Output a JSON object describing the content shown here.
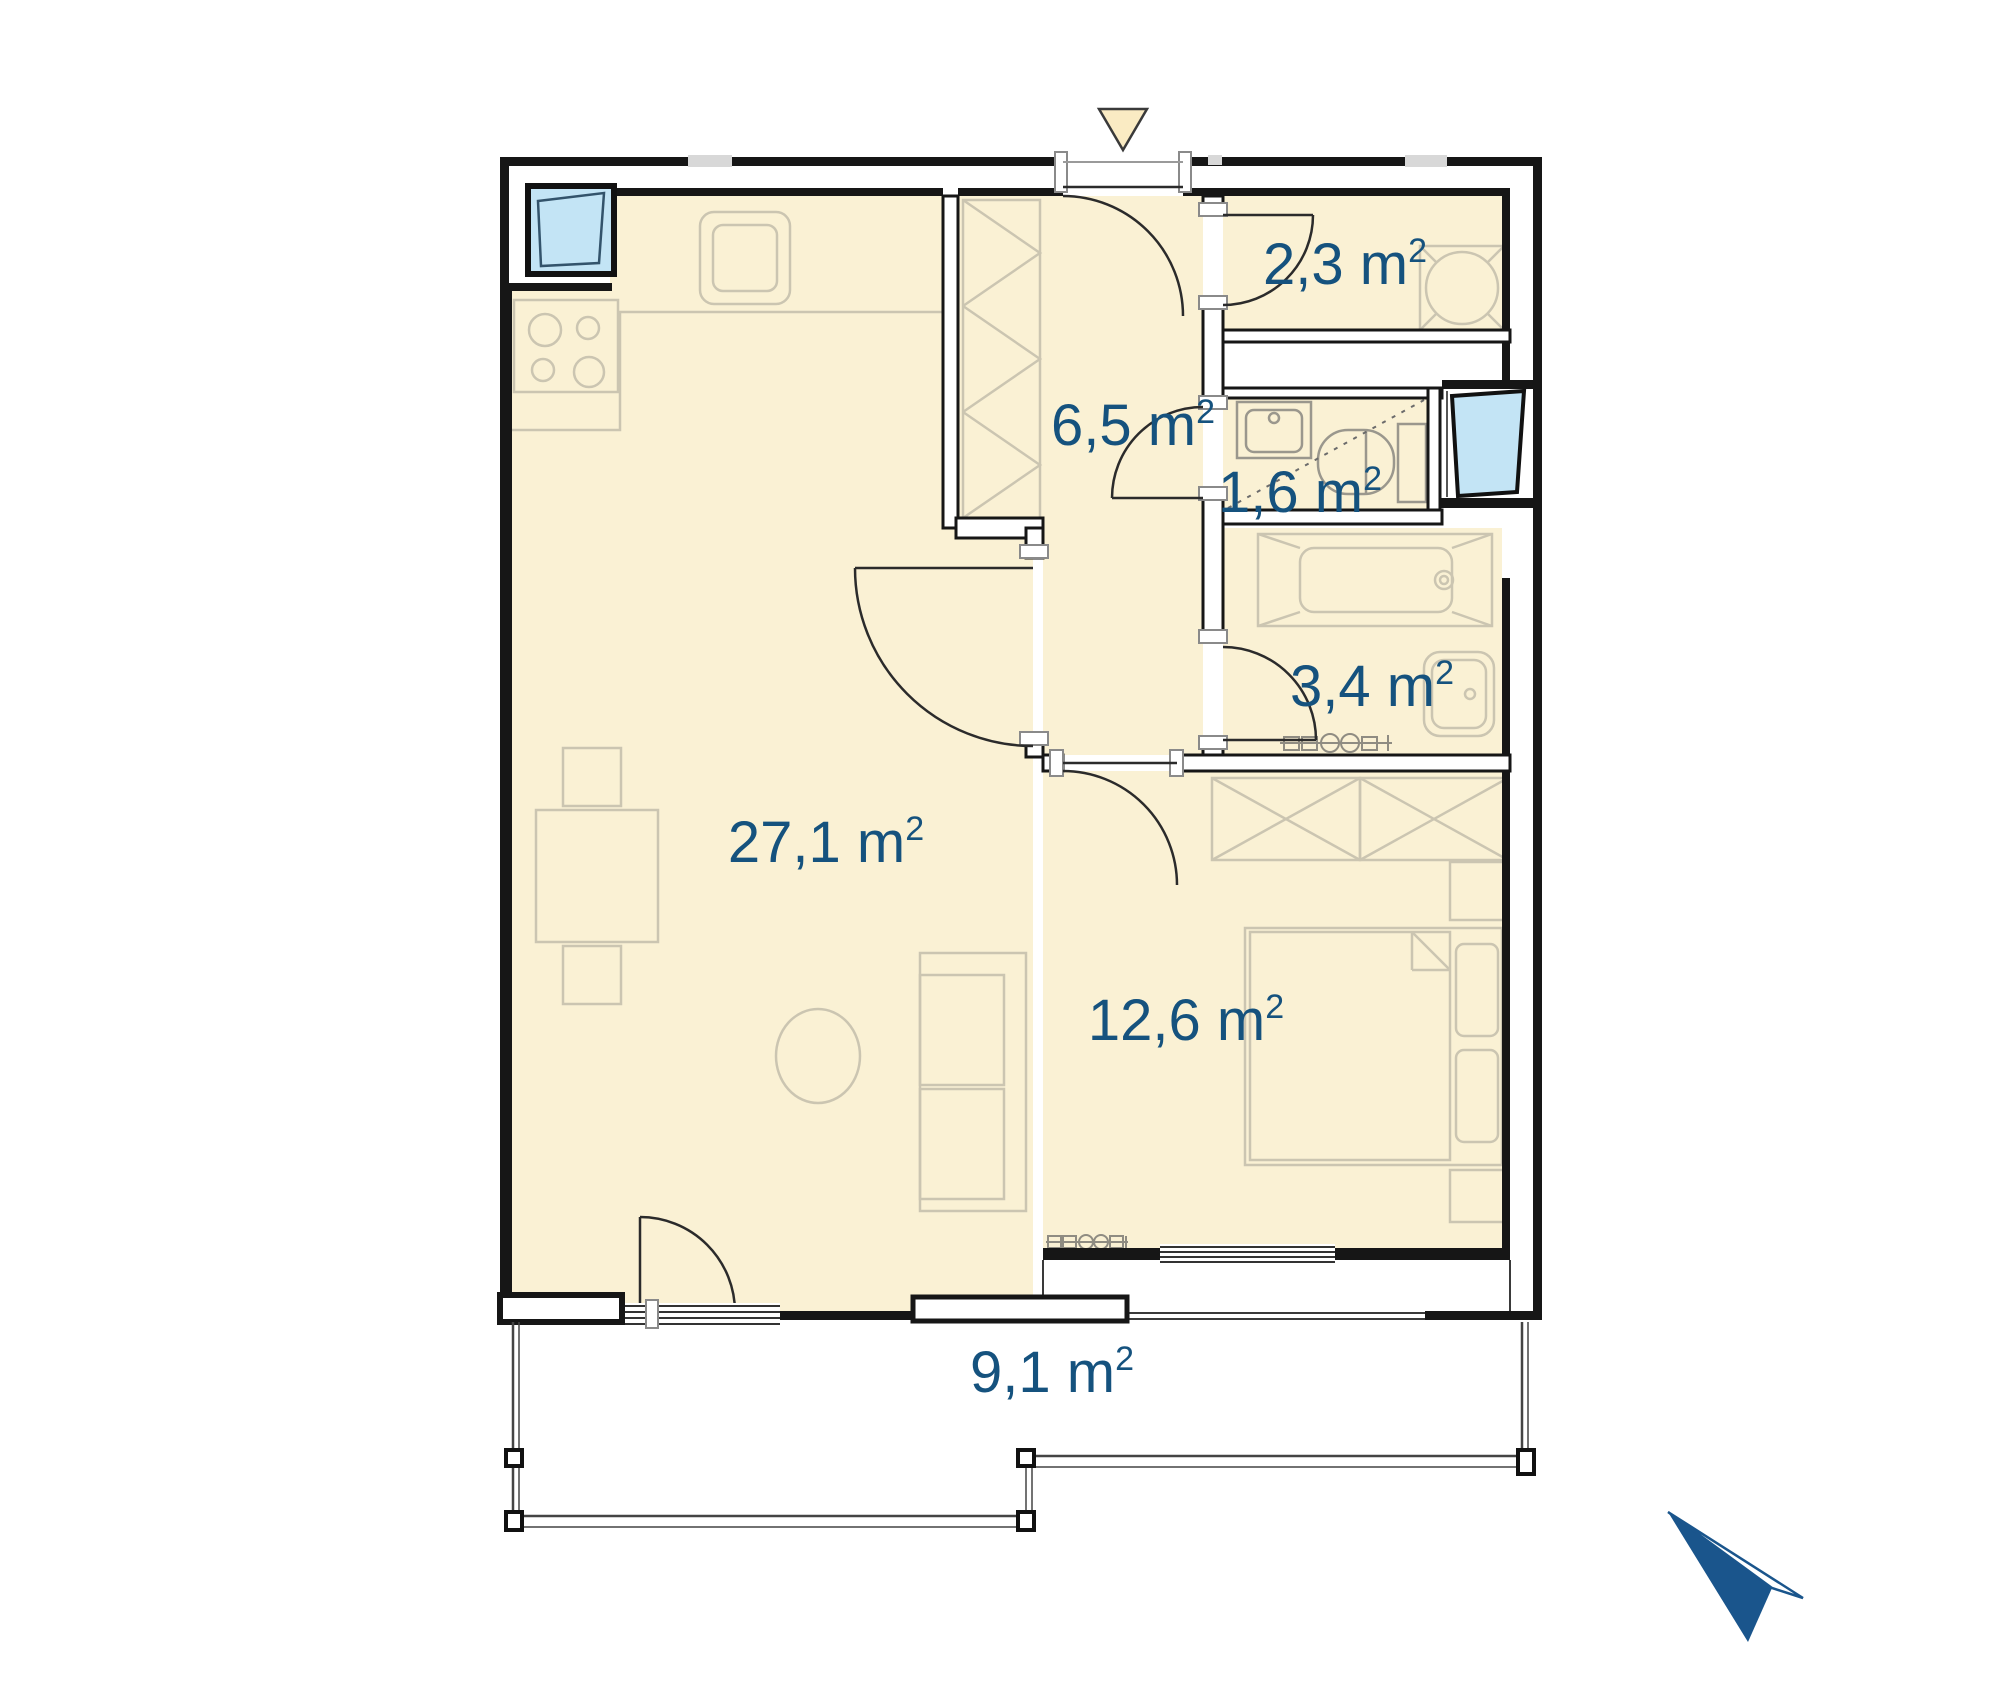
{
  "plan": {
    "title": "apartment-floor-plan",
    "colors": {
      "room_fill": "#FAF1D4",
      "label_blue": "#15527E",
      "window_blue": "#C3E4F5",
      "wall_black": "#161616",
      "furniture_gray": "#CBC5B1",
      "logo_blue": "#1A558C",
      "marker_fill": "#FAEBC3"
    },
    "rooms": [
      {
        "id": "living-kitchen",
        "area": "27,1 m",
        "sup": "2"
      },
      {
        "id": "hallway",
        "area": "6,5 m",
        "sup": "2"
      },
      {
        "id": "storage",
        "area": "2,3 m",
        "sup": "2"
      },
      {
        "id": "wc",
        "area": "1,6 m",
        "sup": "2"
      },
      {
        "id": "bathroom",
        "area": "3,4 m",
        "sup": "2"
      },
      {
        "id": "bedroom",
        "area": "12,6 m",
        "sup": "2"
      },
      {
        "id": "balcony",
        "area": "9,1 m",
        "sup": "2"
      }
    ],
    "icons": {
      "entrance_icon": "triangle-down-entrance-marker",
      "north_icon": "north-arrow-logo"
    }
  }
}
